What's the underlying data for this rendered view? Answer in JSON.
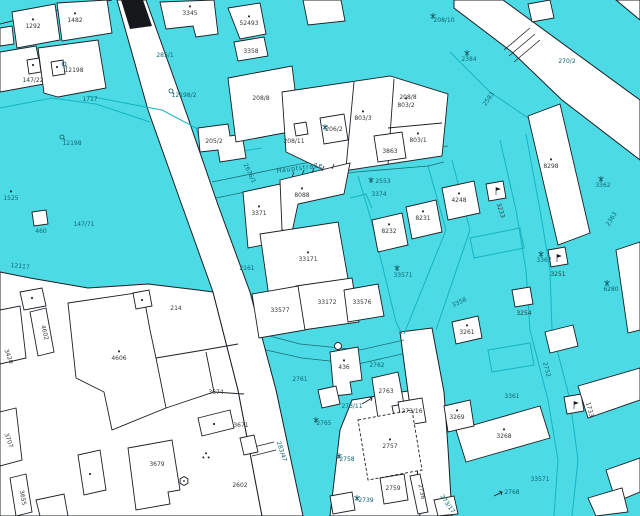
{
  "map": {
    "kind": "cadastral-parcel-map",
    "street_name": "Hauptstraße",
    "colors": {
      "parcel_cyan": "#4cdbe4",
      "boundary_teal": "#17b2c2",
      "street_edge": "#1e6b76",
      "outline_black": "#1b1f24",
      "label_dark": "#34363a",
      "label_teal": "#0d6673",
      "building_white": "#ffffff"
    },
    "labels": [
      {
        "t": "1292",
        "x": 33,
        "y": 28,
        "c": "w",
        "dot": 1
      },
      {
        "t": "1482",
        "x": 75,
        "y": 22,
        "c": "w",
        "dot": 1
      },
      {
        "t": "12198",
        "x": 74,
        "y": 72,
        "c": "w"
      },
      {
        "t": "147/22",
        "x": 33,
        "y": 82,
        "c": "w"
      },
      {
        "t": "3345",
        "x": 190,
        "y": 15,
        "c": "w",
        "dot": 1
      },
      {
        "t": "52493",
        "x": 249,
        "y": 25,
        "c": "w",
        "dot": 1
      },
      {
        "t": "3358",
        "x": 251,
        "y": 53,
        "c": "w"
      },
      {
        "t": "208/8",
        "x": 261,
        "y": 100,
        "c": "w"
      },
      {
        "t": "208/8",
        "x": 408,
        "y": 99,
        "c": "w"
      },
      {
        "t": "208/11",
        "x": 294,
        "y": 143,
        "c": "w"
      },
      {
        "t": "206/2",
        "x": 334,
        "y": 131,
        "c": "w"
      },
      {
        "t": "803/3",
        "x": 363,
        "y": 120,
        "c": "w",
        "dot": 1
      },
      {
        "t": "803/2",
        "x": 406,
        "y": 107,
        "c": "w",
        "dot": 1
      },
      {
        "t": "803/1",
        "x": 418,
        "y": 142,
        "c": "w",
        "dot": 1
      },
      {
        "t": "3863",
        "x": 390,
        "y": 153,
        "c": "w"
      },
      {
        "t": "205/2",
        "x": 214,
        "y": 143,
        "c": "w"
      },
      {
        "t": "3371",
        "x": 259,
        "y": 215,
        "c": "w",
        "dot": 1
      },
      {
        "t": "8088",
        "x": 302,
        "y": 197,
        "c": "w",
        "dot": 1
      },
      {
        "t": "33171",
        "x": 308,
        "y": 261,
        "c": "w",
        "dot": 1
      },
      {
        "t": "33172",
        "x": 327,
        "y": 304,
        "c": "w"
      },
      {
        "t": "33577",
        "x": 280,
        "y": 312,
        "c": "w"
      },
      {
        "t": "33576",
        "x": 362,
        "y": 304,
        "c": "w"
      },
      {
        "t": "8232",
        "x": 389,
        "y": 233,
        "c": "w",
        "dot": 1
      },
      {
        "t": "8231",
        "x": 423,
        "y": 220,
        "c": "w",
        "dot": 1
      },
      {
        "t": "4248",
        "x": 459,
        "y": 202,
        "c": "w",
        "dot": 1
      },
      {
        "t": "8298",
        "x": 551,
        "y": 168,
        "c": "w",
        "dot": 1
      },
      {
        "t": "3268",
        "x": 504,
        "y": 438,
        "c": "w",
        "dot": 1
      },
      {
        "t": "3269",
        "x": 457,
        "y": 419,
        "c": "w",
        "dot": 1
      },
      {
        "t": "3261",
        "x": 467,
        "y": 334,
        "c": "w",
        "dot": 1
      },
      {
        "t": "436",
        "x": 344,
        "y": 369,
        "c": "w",
        "dot": 1
      },
      {
        "t": "2763",
        "x": 386,
        "y": 393,
        "c": "w"
      },
      {
        "t": "2757",
        "x": 390,
        "y": 448,
        "c": "w",
        "dot": 1
      },
      {
        "t": "273/16",
        "x": 412,
        "y": 413,
        "c": "w"
      },
      {
        "t": "2759",
        "x": 393,
        "y": 490,
        "c": "w"
      },
      {
        "t": "2736",
        "x": 420,
        "y": 492,
        "c": "w",
        "r": 78
      },
      {
        "t": "4606",
        "x": 119,
        "y": 360,
        "c": "w",
        "dot": 1
      },
      {
        "t": "214",
        "x": 176,
        "y": 310,
        "c": "w"
      },
      {
        "t": "4602",
        "x": 43,
        "y": 333,
        "c": "w",
        "r": 76
      },
      {
        "t": "3420",
        "x": 7,
        "y": 357,
        "c": "w",
        "r": 70
      },
      {
        "t": "3707",
        "x": 7,
        "y": 441,
        "c": "w",
        "r": 70
      },
      {
        "t": "3655",
        "x": 21,
        "y": 498,
        "c": "w",
        "r": 80
      },
      {
        "t": "3679",
        "x": 157,
        "y": 466,
        "c": "w"
      },
      {
        "t": "3671",
        "x": 241,
        "y": 427,
        "c": "w"
      },
      {
        "t": "3674",
        "x": 216,
        "y": 394,
        "c": "w"
      },
      {
        "t": "2602",
        "x": 240,
        "y": 487,
        "c": "w"
      },
      {
        "t": "3251",
        "x": 558,
        "y": 276,
        "c": "w"
      },
      {
        "t": "3254",
        "x": 524,
        "y": 315,
        "c": "w"
      },
      {
        "t": "3233",
        "x": 499,
        "y": 211,
        "c": "w",
        "r": 72
      },
      {
        "t": "1733",
        "x": 588,
        "y": 410,
        "c": "w",
        "r": 75
      },
      {
        "t": "1717",
        "x": 90,
        "y": 101,
        "c": "t"
      },
      {
        "t": "12198",
        "x": 72,
        "y": 145,
        "c": "t"
      },
      {
        "t": "1525",
        "x": 11,
        "y": 200,
        "c": "t",
        "dot": 1
      },
      {
        "t": "460",
        "x": 41,
        "y": 233,
        "c": "t"
      },
      {
        "t": "147/71",
        "x": 84,
        "y": 226,
        "c": "t"
      },
      {
        "t": "12117",
        "x": 20,
        "y": 268,
        "c": "t",
        "r": 6
      },
      {
        "t": "285/1",
        "x": 165,
        "y": 57,
        "c": "t"
      },
      {
        "t": "12198/2",
        "x": 184,
        "y": 97,
        "c": "t"
      },
      {
        "t": "2676/1",
        "x": 248,
        "y": 174,
        "c": "t",
        "r": 65
      },
      {
        "t": "Hauptstraße",
        "x": 300,
        "y": 170,
        "c": "t street",
        "r": -7,
        "n": "street-name-label"
      },
      {
        "t": "3374",
        "x": 379,
        "y": 196,
        "c": "t"
      },
      {
        "t": "2553",
        "x": 383,
        "y": 183,
        "c": "t"
      },
      {
        "t": "2583",
        "x": 490,
        "y": 100,
        "c": "t",
        "r": -55
      },
      {
        "t": "208/10",
        "x": 444,
        "y": 22,
        "c": "t"
      },
      {
        "t": "2384",
        "x": 469,
        "y": 61,
        "c": "t"
      },
      {
        "t": "270/2",
        "x": 567,
        "y": 63,
        "c": "t"
      },
      {
        "t": "3362",
        "x": 603,
        "y": 187,
        "c": "t"
      },
      {
        "t": "3367",
        "x": 544,
        "y": 262,
        "c": "t"
      },
      {
        "t": "2363",
        "x": 613,
        "y": 220,
        "c": "t",
        "r": -58
      },
      {
        "t": "33571",
        "x": 403,
        "y": 277,
        "c": "t"
      },
      {
        "t": "2161",
        "x": 247,
        "y": 270,
        "c": "t"
      },
      {
        "t": "33571",
        "x": 540,
        "y": 481,
        "c": "t"
      },
      {
        "t": "3361",
        "x": 512,
        "y": 398,
        "c": "t"
      },
      {
        "t": "6280",
        "x": 611,
        "y": 291,
        "c": "t"
      },
      {
        "t": "2752",
        "x": 545,
        "y": 370,
        "c": "t",
        "r": 75
      },
      {
        "t": "3358",
        "x": 460,
        "y": 304,
        "c": "t",
        "r": -25
      },
      {
        "t": "2761",
        "x": 300,
        "y": 381,
        "c": "t"
      },
      {
        "t": "2762",
        "x": 377,
        "y": 367,
        "c": "t"
      },
      {
        "t": "2765",
        "x": 324,
        "y": 425,
        "c": "t"
      },
      {
        "t": "2758",
        "x": 347,
        "y": 461,
        "c": "t"
      },
      {
        "t": "2739",
        "x": 366,
        "y": 502,
        "c": "t"
      },
      {
        "t": "273/11",
        "x": 352,
        "y": 408,
        "c": "t"
      },
      {
        "t": "2768",
        "x": 512,
        "y": 494,
        "c": "t"
      },
      {
        "t": "283/47",
        "x": 280,
        "y": 452,
        "c": "t",
        "r": 72
      },
      {
        "t": "273/17",
        "x": 446,
        "y": 505,
        "c": "t",
        "r": 55
      }
    ],
    "icons": [
      {
        "k": "tree",
        "n": "tree-icon",
        "x": 325,
        "y": 127
      },
      {
        "k": "tree",
        "n": "tree-icon",
        "x": 371,
        "y": 180
      },
      {
        "k": "tree",
        "n": "tree-icon",
        "x": 433,
        "y": 16
      },
      {
        "k": "tree",
        "n": "tree-icon",
        "x": 467,
        "y": 53
      },
      {
        "k": "tree",
        "n": "tree-icon",
        "x": 601,
        "y": 179
      },
      {
        "k": "tree",
        "n": "tree-icon",
        "x": 541,
        "y": 254
      },
      {
        "k": "tree",
        "n": "tree-icon",
        "x": 607,
        "y": 283
      },
      {
        "k": "tree",
        "n": "tree-icon",
        "x": 397,
        "y": 268
      },
      {
        "k": "tree",
        "n": "tree-icon",
        "x": 316,
        "y": 420
      },
      {
        "k": "tree",
        "n": "tree-icon",
        "x": 339,
        "y": 456
      },
      {
        "k": "tree",
        "n": "tree-icon",
        "x": 357,
        "y": 498
      },
      {
        "k": "circ",
        "n": "survey-mark-icon",
        "x": 64,
        "y": 64
      },
      {
        "k": "circ",
        "n": "survey-mark-icon",
        "x": 62,
        "y": 137
      },
      {
        "k": "circ",
        "n": "survey-mark-icon",
        "x": 171,
        "y": 91
      },
      {
        "k": "flag",
        "n": "flag-icon",
        "x": 496,
        "y": 191
      },
      {
        "k": "flag",
        "n": "flag-icon",
        "x": 557,
        "y": 258
      },
      {
        "k": "flag",
        "n": "flag-icon",
        "x": 574,
        "y": 405
      },
      {
        "k": "hex",
        "n": "well-icon",
        "x": 184,
        "y": 481
      },
      {
        "k": "tridots",
        "n": "boundary-dots-icon",
        "x": 206,
        "y": 456
      },
      {
        "k": "sq",
        "n": "house-dot-icon",
        "x": 33,
        "y": 65
      },
      {
        "k": "sq",
        "n": "house-dot-icon",
        "x": 57,
        "y": 67
      },
      {
        "k": "sq",
        "n": "house-dot-icon",
        "x": 32,
        "y": 298
      },
      {
        "k": "sq",
        "n": "house-dot-icon",
        "x": 90,
        "y": 474
      },
      {
        "k": "sq",
        "n": "house-dot-icon",
        "x": 214,
        "y": 424
      },
      {
        "k": "sq",
        "n": "house-dot-icon",
        "x": 142,
        "y": 300
      }
    ]
  }
}
